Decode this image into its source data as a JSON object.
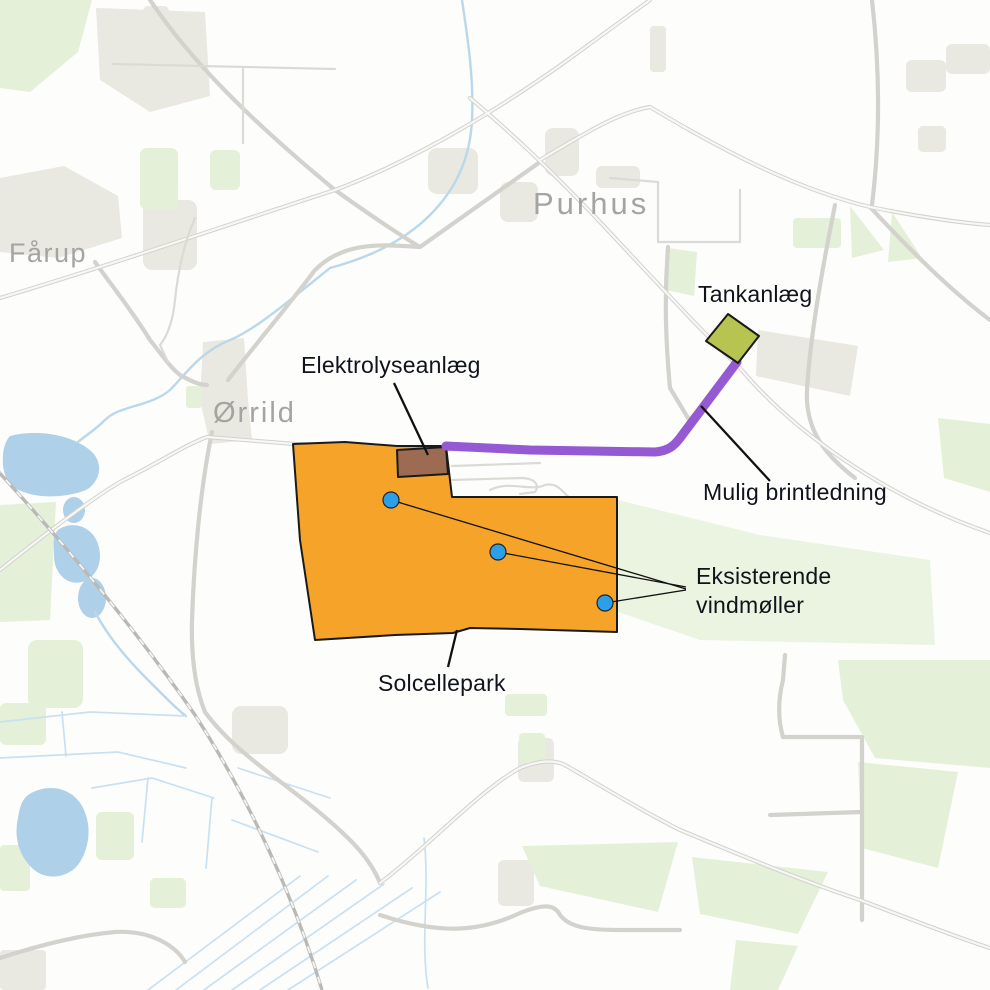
{
  "map": {
    "place_labels": [
      {
        "id": "faarup",
        "text": "Fårup"
      },
      {
        "id": "purhus",
        "text": "Purhus"
      },
      {
        "id": "oerrild",
        "text": "Ørrild"
      }
    ],
    "annotations": {
      "tankanlaeg": "Tankanlæg",
      "elektrolyseanlaeg": "Elektrolyseanlæg",
      "brintledning": "Mulig brintledning",
      "vindmoeller_line1": "Eksisterende",
      "vindmoeller_line2": "vindmøller",
      "solcellepark": "Solcellepark"
    },
    "features": {
      "wind_turbine_count": 3
    },
    "colors": {
      "solcellepark": "#F6A429",
      "elektrolyseanlaeg": "#9C6B52",
      "tankanlaeg": "#B7C44F",
      "brintledning": "#9659D4",
      "vindmoelle": "#2B9FE8",
      "outline": "#1A1A1A",
      "place_label": "#A4A4A2",
      "annotation_text": "#10131C",
      "water": "#AED0E8",
      "green_area": "#E5F0D8",
      "built_up_area": "#E9E8E1",
      "road": "#D3D2CD"
    }
  }
}
